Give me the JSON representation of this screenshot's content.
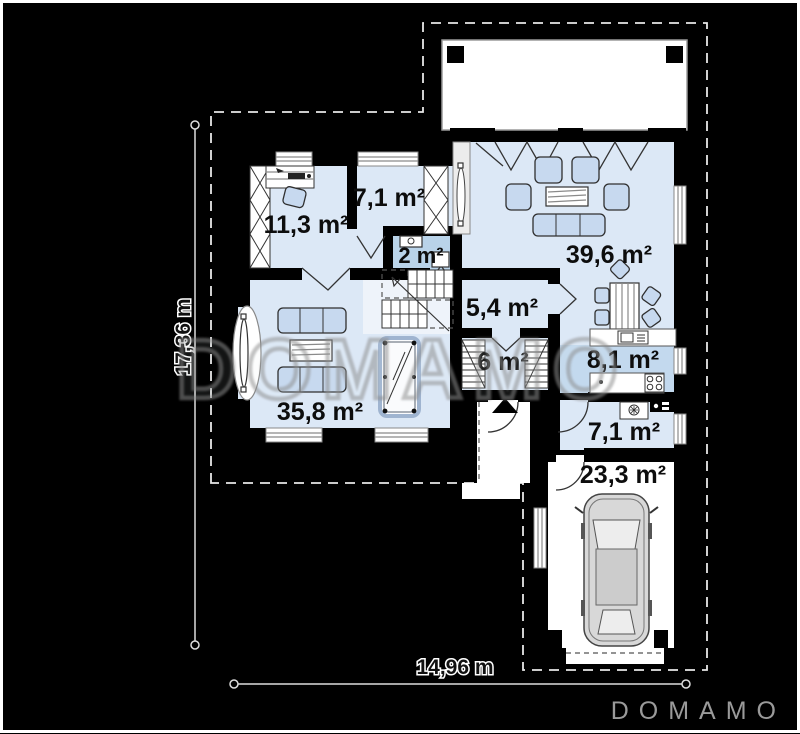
{
  "title": "Single-storey house floor plan",
  "watermark": {
    "text": "DOMAMO"
  },
  "brand": {
    "logo": "DOMAMO"
  },
  "dimensions": {
    "height_label": "17,36 m",
    "width_label": "14,96 m"
  },
  "rooms": [
    {
      "id": "office",
      "label": "11,3 m²"
    },
    {
      "id": "room-top",
      "label": "7,1 m²"
    },
    {
      "id": "wc",
      "label": "2 m²"
    },
    {
      "id": "living-dining",
      "label": "39,6 m²"
    },
    {
      "id": "hall",
      "label": "5,4 m²"
    },
    {
      "id": "corridor",
      "label": "6 m²"
    },
    {
      "id": "kitchen",
      "label": "8,1 m²"
    },
    {
      "id": "utility",
      "label": "7,1 m²"
    },
    {
      "id": "living-room",
      "label": "35,8 m²"
    },
    {
      "id": "garage",
      "label": "23,3 m²"
    }
  ],
  "colors": {
    "background": "#000000",
    "room_fill": "#dce8f6",
    "kitchen_fill": "#c3d9ee",
    "wc_fill": "#b9d3e9",
    "furniture_fill": "#c7d9ef",
    "outside_fill": "#ffffff",
    "logo_gray": "#9a9a9a"
  }
}
